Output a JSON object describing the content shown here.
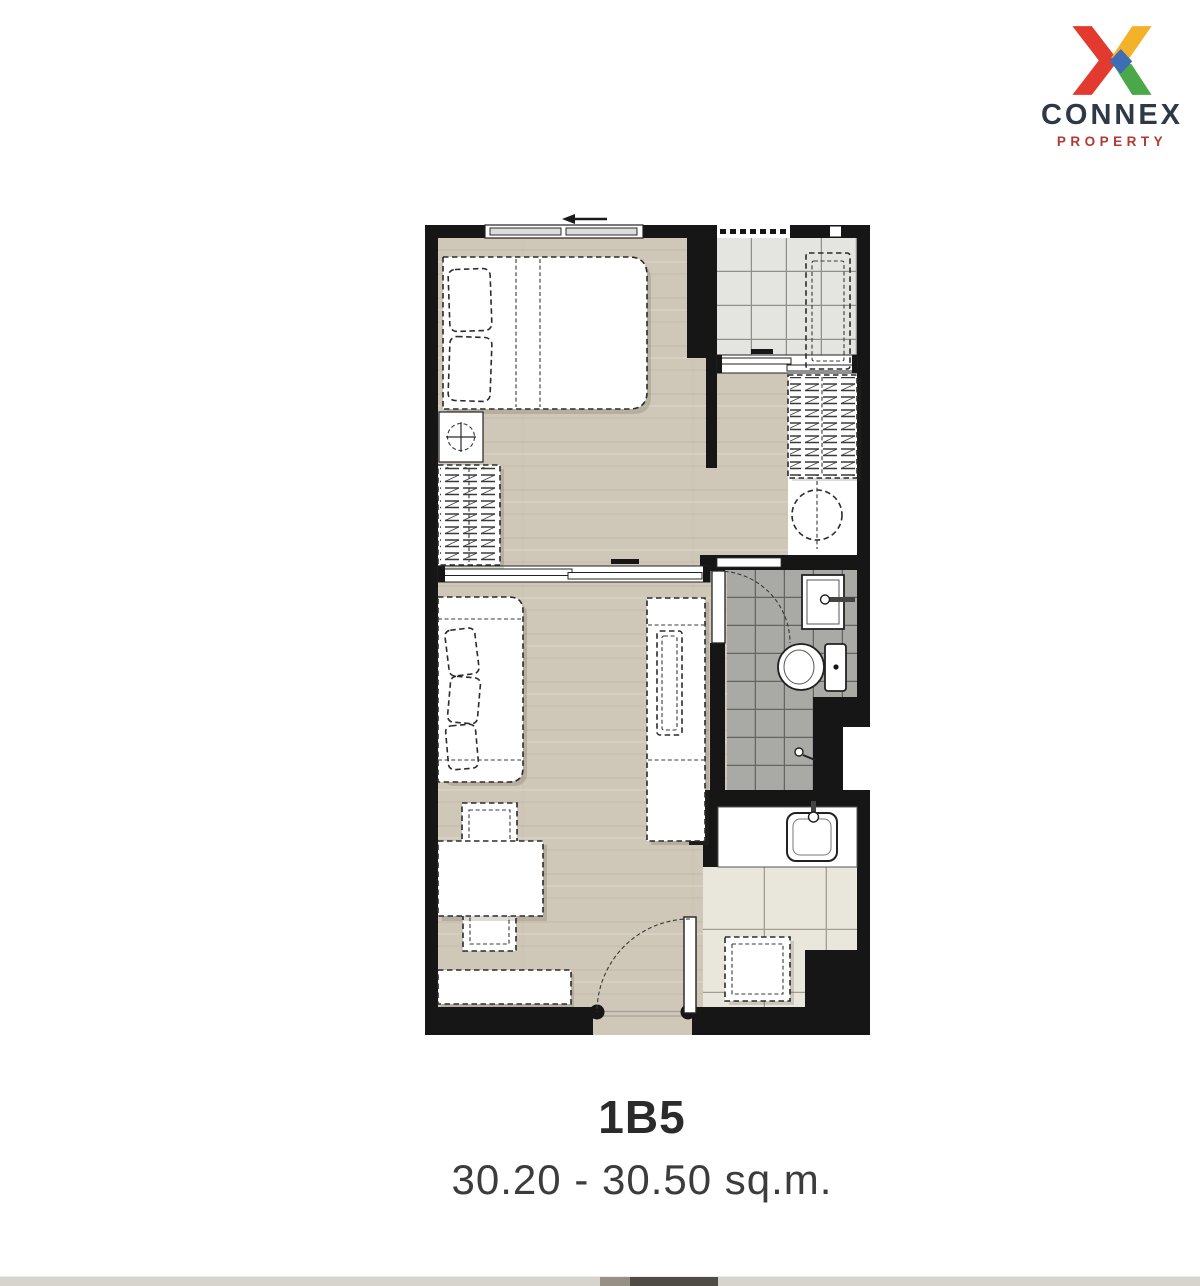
{
  "brand": {
    "name": "CONNEX",
    "tagline": "PROPERTY",
    "logo_mark": "multicolor-x",
    "colors": {
      "red": "#e23a2e",
      "yellow": "#f2b32a",
      "blue": "#3e6cb5",
      "green": "#4ba848",
      "wordmark": "#2e3947",
      "tagline": "#b23a30"
    }
  },
  "unit": {
    "name": "1B5",
    "area_range": "30.20 - 30.50 sq.m."
  },
  "floorplan": {
    "palette": {
      "wall": "#161616",
      "wood_floor": "#cfc7b8",
      "balcony_tile": "#e4e4e1",
      "bathroom_tile": "#a9a9a6",
      "kitchen_tile": "#e9e6db",
      "furniture_line": "#2b2b2b"
    },
    "rooms": [
      "bedroom",
      "living-dining",
      "balcony",
      "dressing-corridor",
      "bathroom",
      "kitchenette"
    ],
    "furniture": [
      "double-bed",
      "pillows",
      "bedroom-wardrobe",
      "dressing-stool",
      "corridor-wardrobe",
      "washing-machine",
      "air-conditioner-unit",
      "sofa",
      "dining-table",
      "dining-chairs",
      "tv-console",
      "low-cabinet",
      "toilet",
      "bathroom-sink",
      "kitchen-counter",
      "kitchen-sink",
      "kitchen-stool",
      "entrance-door",
      "bathroom-door",
      "sliding-partition",
      "balcony-sliding-door",
      "bedroom-window"
    ]
  },
  "footer_strip": {
    "base_color": "#d7d4cd",
    "accent_color": "#4f4b45"
  }
}
